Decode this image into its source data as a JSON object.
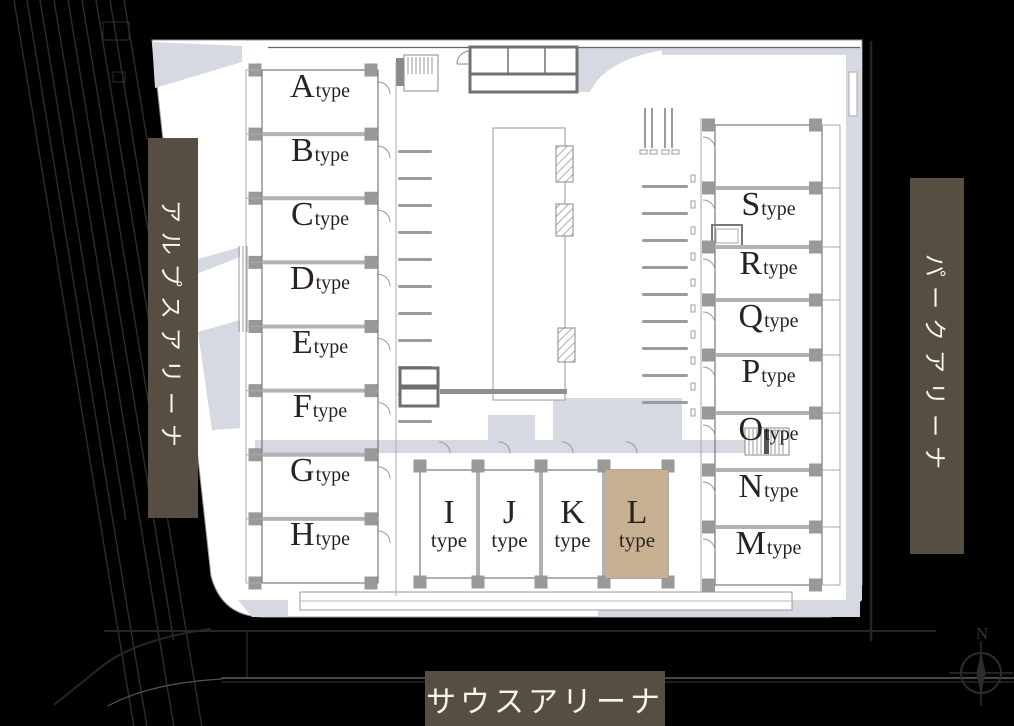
{
  "site": {
    "left_banner_label": "アルプスアリーナ",
    "right_banner_label": "パークアリーナ",
    "bottom_banner_label": "サウスアリーナ"
  },
  "units": {
    "type_suffix": "type",
    "left_column": [
      "A",
      "B",
      "C",
      "D",
      "E",
      "F",
      "G",
      "H"
    ],
    "right_column": [
      "S",
      "R",
      "Q",
      "P",
      "O",
      "N",
      "M"
    ],
    "bottom_row": [
      "I",
      "J",
      "K",
      "L"
    ],
    "highlighted_unit": "L"
  },
  "compass": {
    "north_label": "N"
  },
  "colors": {
    "background": "#000000",
    "banner": "#564e41",
    "banner_text": "#f7f5ee",
    "highlight": "#c8b192",
    "walkway": "#d7d9e2",
    "unit_text": "#2a2220"
  }
}
